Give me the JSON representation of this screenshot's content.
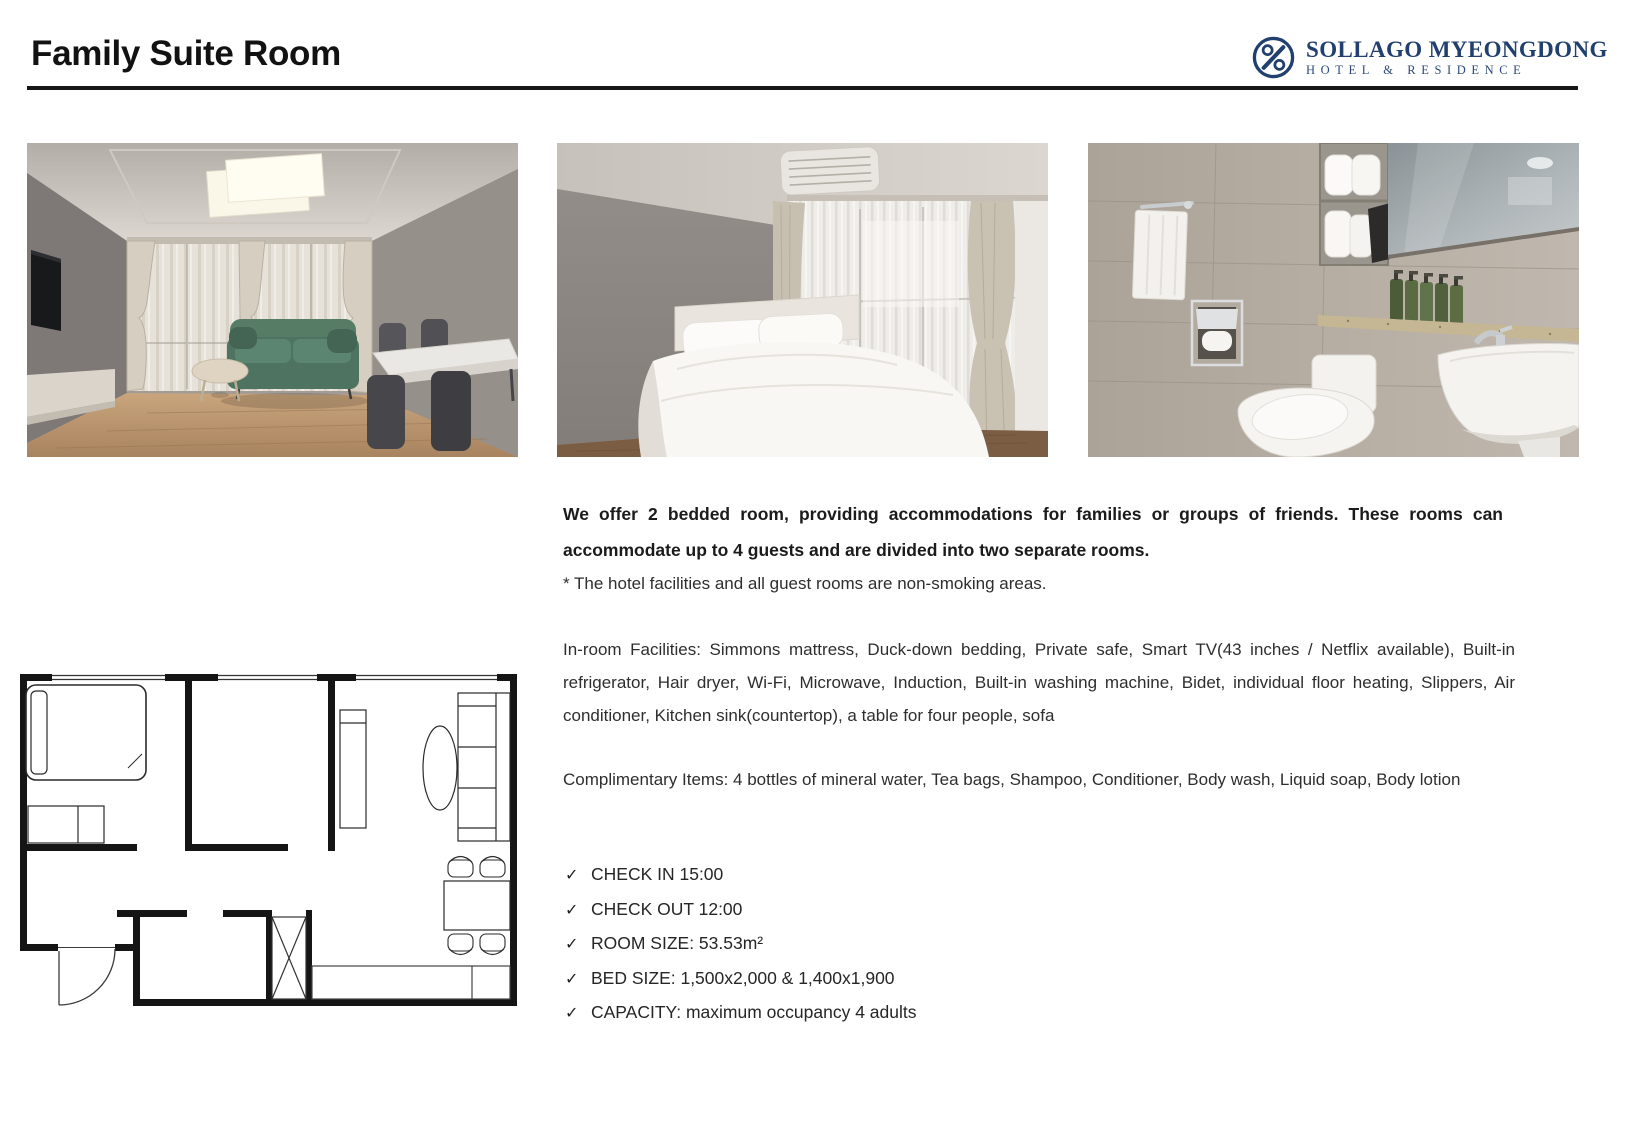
{
  "header": {
    "title": "Family Suite Room",
    "logo": {
      "name": "SOLLAGO MYEONGDONG",
      "subtitle": "HOTEL & RESIDENCE",
      "brand_color": "#21406f",
      "icon": "circle-percent-monogram-icon"
    },
    "divider_color": "#161616"
  },
  "photos": [
    {
      "label": "living-room-photo"
    },
    {
      "label": "bedroom-photo"
    },
    {
      "label": "bathroom-photo"
    }
  ],
  "floor_plan": {
    "label": "room-floor-plan"
  },
  "description": {
    "intro": "We offer 2 bedded room, providing accommodations for families or groups of friends. These rooms can accommodate up to 4 guests and are divided into two separate rooms.",
    "note": "* The hotel facilities and all guest rooms are non-smoking areas.",
    "facilities": "In-room Facilities: Simmons mattress, Duck-down bedding, Private safe, Smart TV(43 inches / Netflix available), Built-in refrigerator, Hair dryer, Wi-Fi, Microwave, Induction, Built-in washing machine, Bidet, individual floor heating, Slippers, Air conditioner, Kitchen sink(countertop), a table for four people, sofa",
    "complimentary": "Complimentary Items: 4 bottles of mineral water, Tea bags, Shampoo, Conditioner, Body wash, Liquid soap, Body lotion"
  },
  "checklist": {
    "bullet": "✓",
    "items": [
      "CHECK IN 15:00",
      "CHECK OUT 12:00",
      "ROOM SIZE: 53.53m²",
      "BED SIZE: 1,500x2,000 & 1,400x1,900",
      "CAPACITY: maximum occupancy 4 adults"
    ]
  }
}
